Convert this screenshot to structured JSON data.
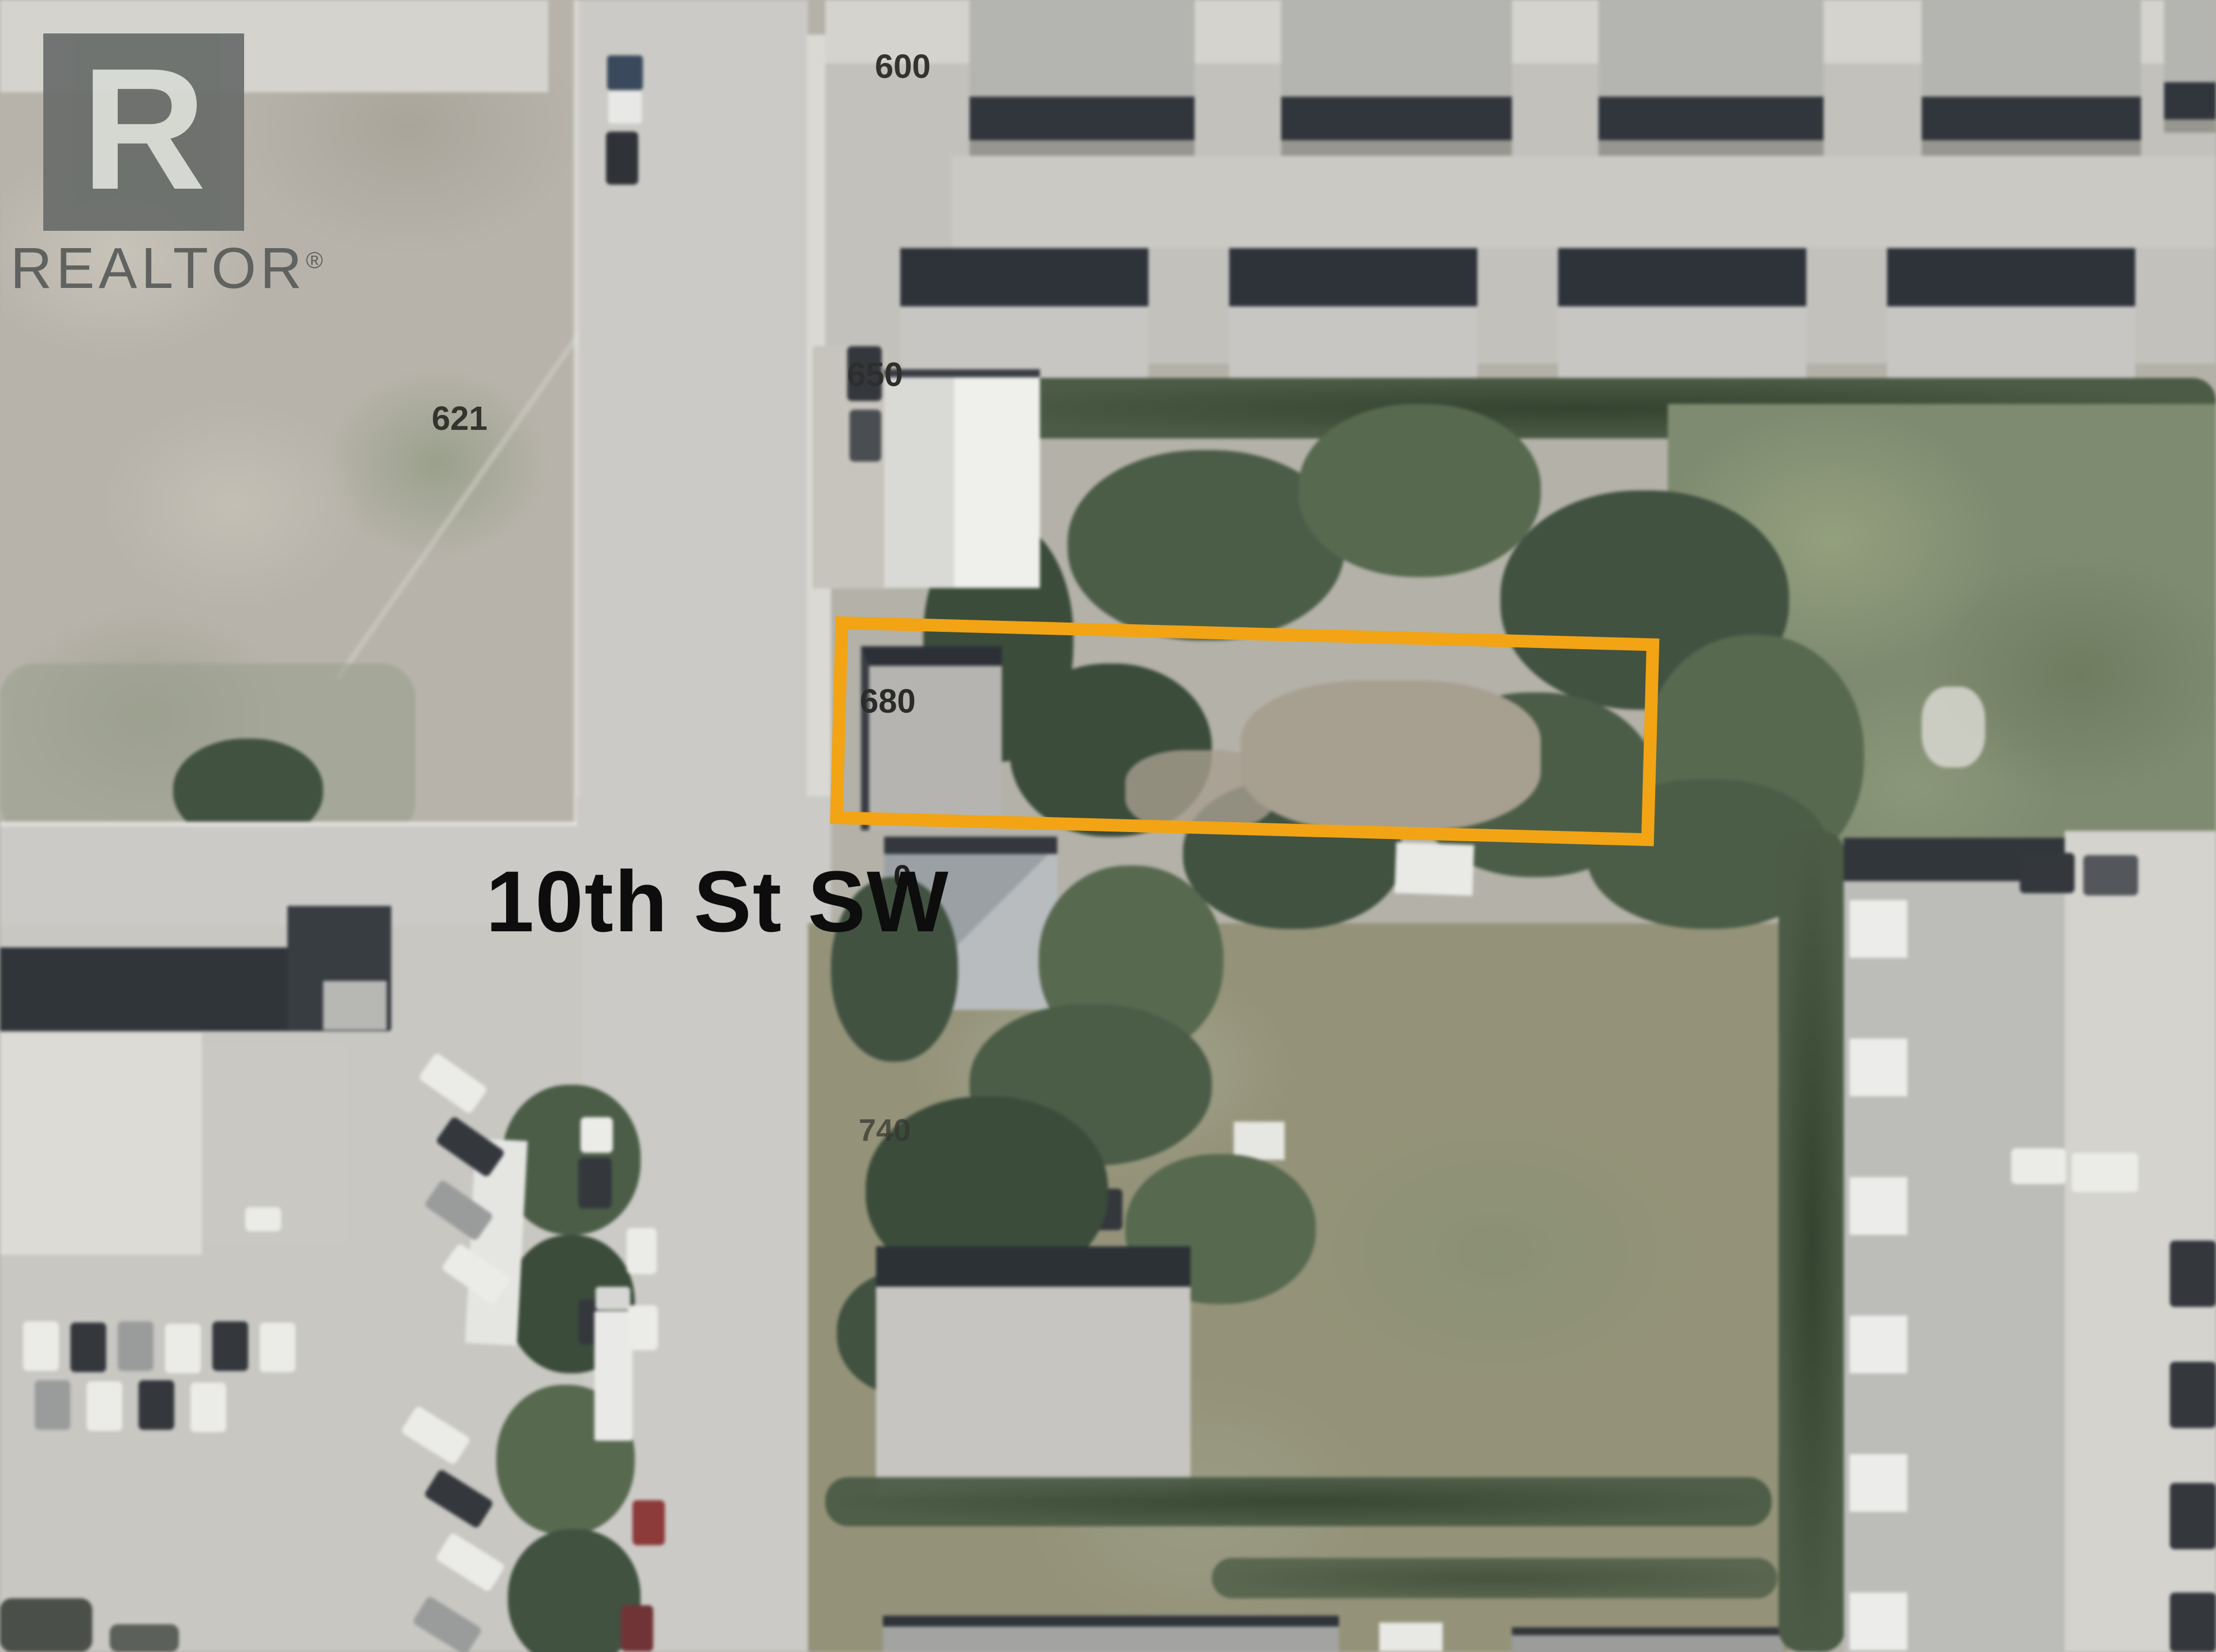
{
  "watermark": {
    "letter": "R",
    "brand": "REALTOR",
    "reg": "®"
  },
  "street_label": "10th St SW",
  "parcel_labels": {
    "n600": "600",
    "n621": "621",
    "n650": "650",
    "n680": "680",
    "n710_partial": "0",
    "n740": "740"
  },
  "highlight": {
    "color": "#F2A414"
  }
}
